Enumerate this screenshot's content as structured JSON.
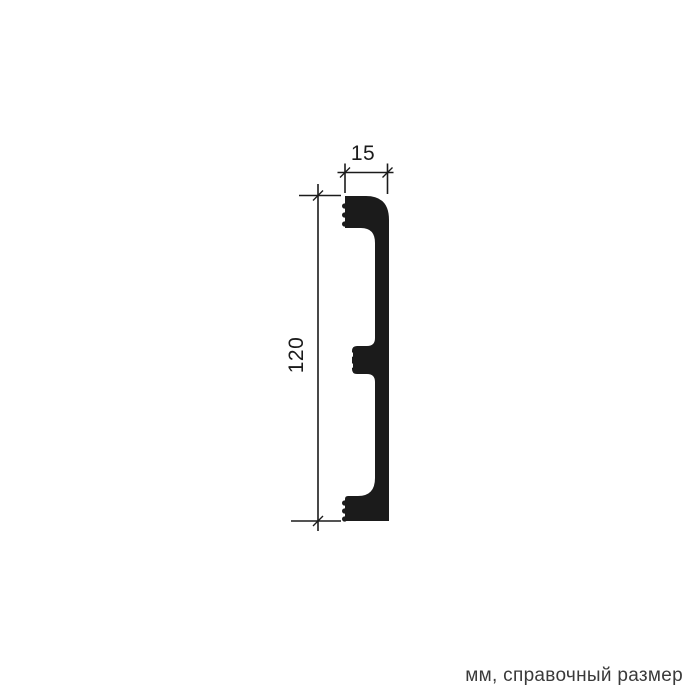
{
  "drawing": {
    "kind": "profile cross-section technical drawing",
    "dimensions": {
      "width_label": "15",
      "height_label": "120"
    },
    "caption": "мм, справочный размер",
    "colors": {
      "line": "#1b1b1b",
      "profile_fill": "#1b1b1b",
      "caption_text": "#3a3a3a",
      "background": "#ffffff"
    }
  }
}
